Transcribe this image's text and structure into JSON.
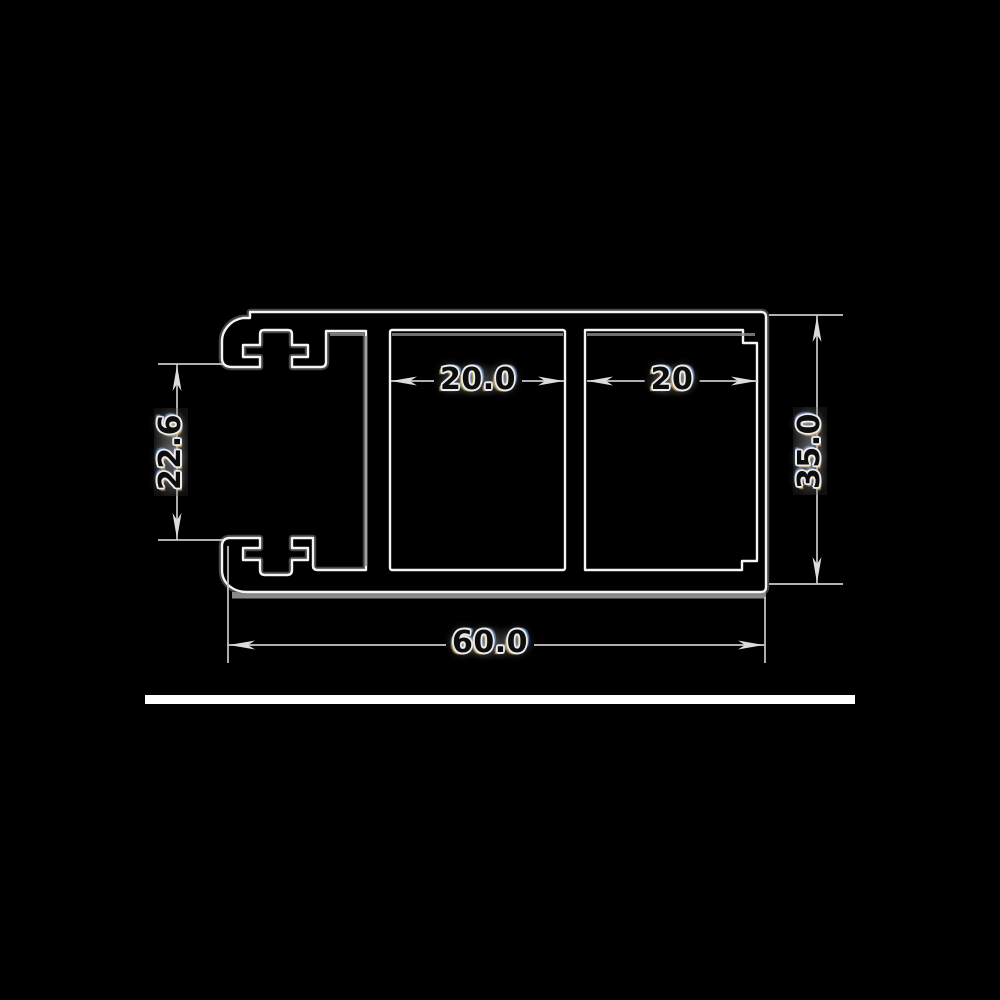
{
  "drawing": {
    "dimensions": {
      "middle_chamber_width": "20.0",
      "right_chamber_width": "20",
      "left_opening_height": "22.6",
      "overall_height": "35.0",
      "overall_width": "60.0"
    },
    "colors": {
      "background": "#000000",
      "outline": "#f4f4f4",
      "dimension_line": "#c9c9c9",
      "text": "#0d0d0d",
      "text_halo": "#ececec",
      "baseline_strip": "#ffffff"
    }
  }
}
